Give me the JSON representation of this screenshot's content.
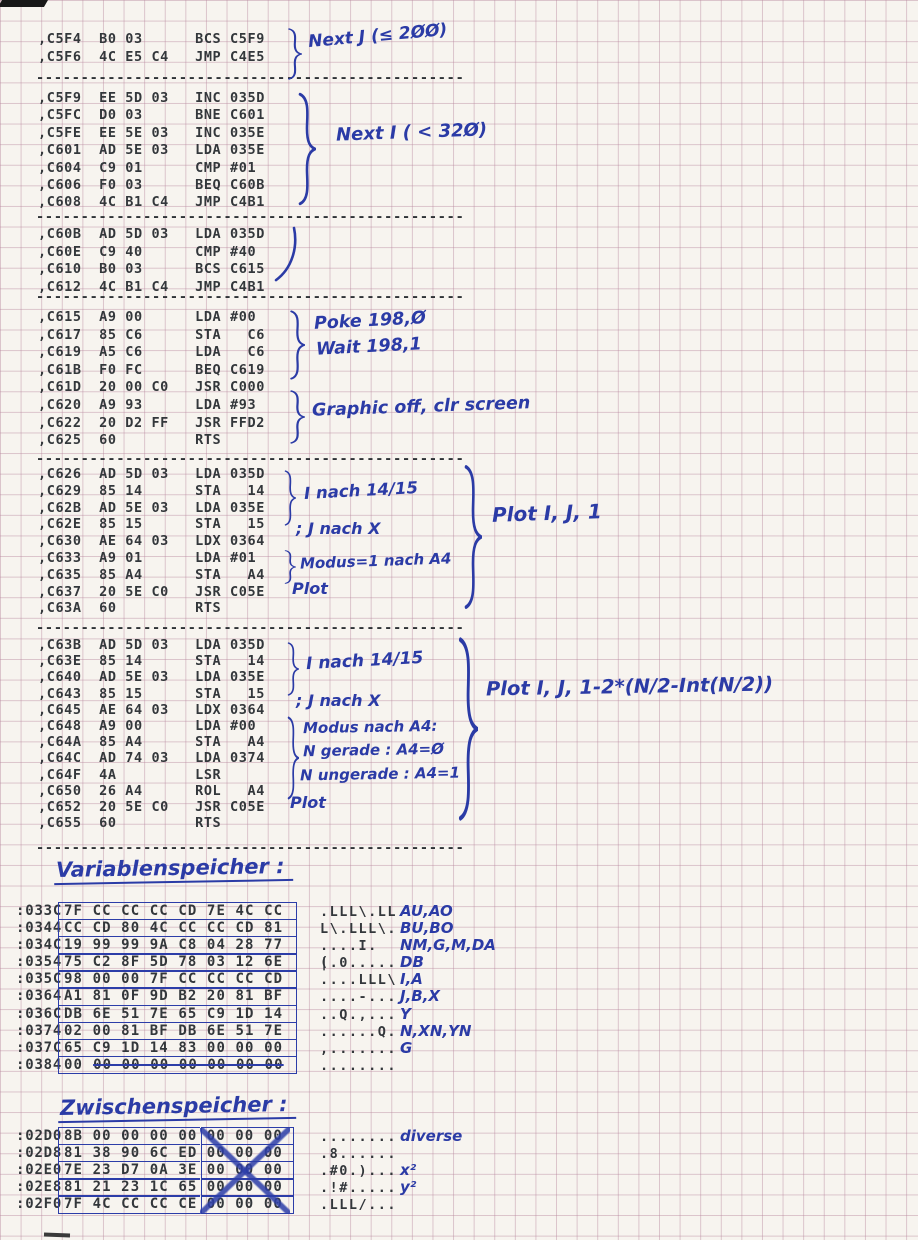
{
  "separator": "------------------------------------------------",
  "code_blocks": [
    {
      "text": ",C5F4  B0 03      BCS C5F9\n,C5F6  4C E5 C4   JMP C4E5"
    },
    {
      "text": ",C5F9  EE 5D 03   INC 035D\n,C5FC  D0 03      BNE C601\n,C5FE  EE 5E 03   INC 035E\n,C601  AD 5E 03   LDA 035E\n,C604  C9 01      CMP #01\n,C606  F0 03      BEQ C60B\n,C608  4C B1 C4   JMP C4B1"
    },
    {
      "text": ",C60B  AD 5D 03   LDA 035D\n,C60E  C9 40      CMP #40\n,C610  B0 03      BCS C615\n,C612  4C B1 C4   JMP C4B1"
    },
    {
      "text": ",C615  A9 00      LDA #00\n,C617  85 C6      STA   C6\n,C619  A5 C6      LDA   C6\n,C61B  F0 FC      BEQ C619\n,C61D  20 00 C0   JSR C000\n,C620  A9 93      LDA #93\n,C622  20 D2 FF   JSR FFD2\n,C625  60         RTS"
    },
    {
      "text": ",C626  AD 5D 03   LDA 035D\n,C629  85 14      STA   14\n,C62B  AD 5E 03   LDA 035E\n,C62E  85 15      STA   15\n,C630  AE 64 03   LDX 0364\n,C633  A9 01      LDA #01\n,C635  85 A4      STA   A4\n,C637  20 5E C0   JSR C05E\n,C63A  60         RTS"
    },
    {
      "text": ",C63B  AD 5D 03   LDA 035D\n,C63E  85 14      STA   14\n,C640  AD 5E 03   LDA 035E\n,C643  85 15      STA   15\n,C645  AE 64 03   LDX 0364\n,C648  A9 00      LDA #00\n,C64A  85 A4      STA   A4\n,C64C  AD 74 03   LDA 0374\n,C64F  4A         LSR\n,C650  26 A4      ROL   A4\n,C652  20 5E C0   JSR C05E\n,C655  60         RTS"
    }
  ],
  "annotations": {
    "next_j": "Next J (≤ 2ØØ)",
    "next_i": "Next I ( < 32Ø)",
    "poke": "Poke 198,Ø",
    "wait": "Wait 198,1",
    "graphic": "Graphic off, clr screen",
    "b5_i": "I nach 14/15",
    "b5_j": "; J nach X",
    "b5_modus": "Modus=1 nach A4",
    "b5_plot": "Plot",
    "b5_call": "Plot I, J, 1",
    "b6_i": "I nach 14/15",
    "b6_j": "; J nach X",
    "b6_modus": "Modus nach A4:",
    "b6_gerade": "N gerade : A4=Ø",
    "b6_ungerade": "N ungerade : A4=1",
    "b6_plot": "Plot",
    "b6_call": "Plot I, J, 1-2*(N/2-Int(N/2))"
  },
  "variablen": {
    "title": "Variablenspeicher :",
    "rows": [
      {
        "addr": ":033C",
        "bytes": "7F CC CC CC CD 7E 4C CC",
        "ascii": ".LLL\\.LL",
        "label": "AU,AO"
      },
      {
        "addr": ":0344",
        "bytes": "CC CD 80 4C CC CC CD 81",
        "ascii": "L\\.LLL\\.",
        "label": "BU,BO"
      },
      {
        "addr": ":034C",
        "bytes": "19 99 99 9A C8 04 28 77",
        "ascii": "....I.(",
        "label": "NM,G,M,DA"
      },
      {
        "addr": ":0354",
        "bytes": "75 C2 8F 5D 78 03 12 6E",
        "ascii": "|.0.....",
        "label": "DB"
      },
      {
        "addr": ":035C",
        "bytes": "98 00 00 7F CC CC CC CD",
        "ascii": "....LLL\\",
        "label": "I,A"
      },
      {
        "addr": ":0364",
        "bytes": "A1 81 0F 9D B2 20 81 BF",
        "ascii": "....-...",
        "label": "J,B,X"
      },
      {
        "addr": ":036C",
        "bytes": "DB 6E 51 7E 65 C9 1D 14",
        "ascii": "..Q.,...",
        "label": "Y"
      },
      {
        "addr": ":0374",
        "bytes": "02 00 81 BF DB 6E 51 7E",
        "ascii": "......Q.",
        "label": "N,XN,YN"
      },
      {
        "addr": ":037C",
        "bytes": "65 C9 1D 14 83 00 00 00",
        "ascii": ",.......",
        "label": "G"
      },
      {
        "addr": ":0384",
        "b1": "00",
        "b2": "00 00 00 00 00 00 00",
        "ascii": "........",
        "label": ""
      }
    ]
  },
  "zwischen": {
    "title": "Zwischenspeicher :",
    "rows": [
      {
        "addr": ":02D0",
        "b1": "8B 00 00 00 00",
        "b2": "00 00 00",
        "ascii": "........",
        "label": "diverse"
      },
      {
        "addr": ":02D8",
        "b1": "81 38 90 6C ED",
        "b2": "00 00 00",
        "ascii": ".8......",
        "label": ""
      },
      {
        "addr": ":02E0",
        "b1": "7E 23 D7 0A 3E",
        "b2": "00 00 00",
        "ascii": ".#0.)...",
        "label": "x²"
      },
      {
        "addr": ":02E8",
        "b1": "81 21 23 1C 65",
        "b2": "00 00 00",
        "ascii": ".!#.....",
        "label": "y²"
      },
      {
        "addr": ":02F0",
        "b1": "7F 4C CC CC CE",
        "b2": "00 00 00",
        "ascii": ".LLL/...",
        "label": ""
      }
    ]
  }
}
